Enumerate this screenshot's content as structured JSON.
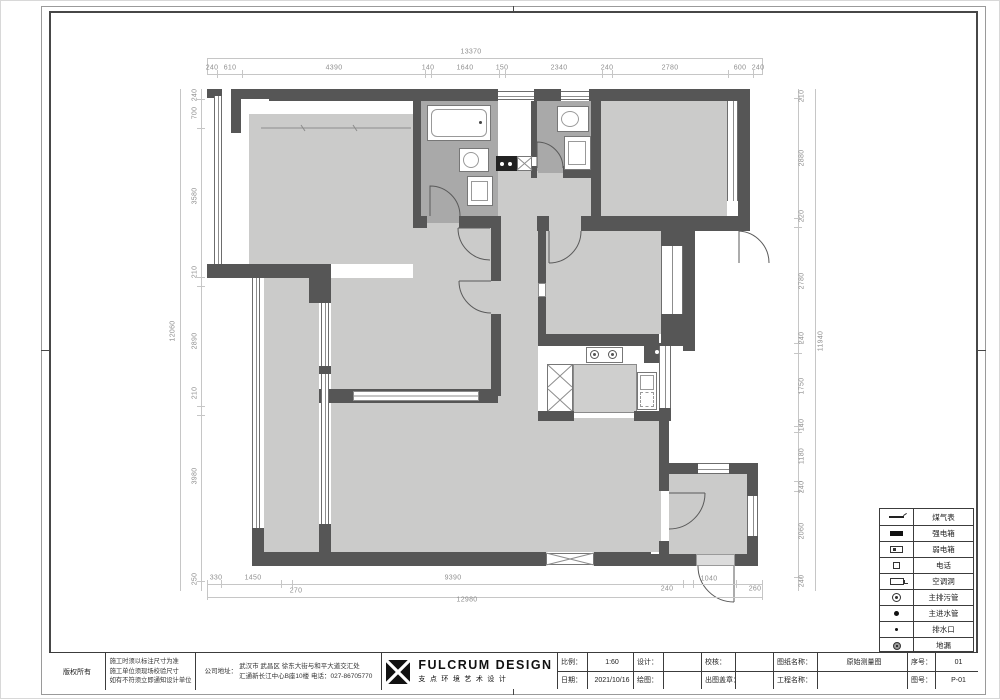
{
  "sheet": {
    "doc_type_note": "architectural floor plan sheet"
  },
  "dimensions": {
    "top": {
      "overall": "13370",
      "segments": [
        "240",
        "610",
        "4390",
        "140",
        "1640",
        "150",
        "2340",
        "240",
        "2780",
        "600",
        "240"
      ]
    },
    "left": {
      "overall": "12060",
      "segments": [
        "240",
        "700",
        "3580",
        "210",
        "2890",
        "210",
        "3980",
        "250"
      ]
    },
    "right": {
      "overall": "11940",
      "segments": [
        "210",
        "2880",
        "220",
        "2780",
        "240",
        "1750",
        "140",
        "1180",
        "240",
        "2060",
        "240"
      ]
    },
    "bottom": {
      "overall": "12980",
      "segments": [
        "330",
        "1450",
        "270",
        "9390",
        "240",
        "1040",
        "260"
      ]
    }
  },
  "legend": {
    "rows": [
      {
        "icon": "gas-meter-icon",
        "label": "煤气表"
      },
      {
        "icon": "strong-power-box-icon",
        "label": "强电箱"
      },
      {
        "icon": "weak-power-box-icon",
        "label": "弱电箱"
      },
      {
        "icon": "telephone-icon",
        "label": "电话"
      },
      {
        "icon": "ac-hole-icon",
        "label": "空调洞"
      },
      {
        "icon": "main-sewage-pipe-icon",
        "label": "主排污管"
      },
      {
        "icon": "main-water-inlet-icon",
        "label": "主进水管"
      },
      {
        "icon": "drain-outlet-icon",
        "label": "排水口"
      },
      {
        "icon": "floor-drain-icon",
        "label": "地漏"
      }
    ]
  },
  "title_block": {
    "copyright": "版权所有",
    "notes": [
      "施工时须以标注尺寸为准",
      "施工单位须现场校验尺寸",
      "如有不符须立即通知设计单位"
    ],
    "address_label": "公司地址：",
    "address_line1": "武汉市 武昌区 徐东大街与和平大道交汇处",
    "address_line2": "汇通新长江中心B座10楼 电话：027-86705770",
    "brand_en": "FULCRUM DESIGN",
    "brand_cn": "支点环境艺术设计",
    "row1": [
      {
        "label": "比例：",
        "value": "1:60"
      },
      {
        "label": "设计：",
        "value": ""
      },
      {
        "label": "校核：",
        "value": ""
      },
      {
        "label": "图纸名称：",
        "value": "原始测量图"
      },
      {
        "label": "序号：",
        "value": "01"
      }
    ],
    "row2": [
      {
        "label": "日期：",
        "value": "2021/10/16"
      },
      {
        "label": "绘图：",
        "value": ""
      },
      {
        "label": "出图盖章：",
        "value": ""
      },
      {
        "label": "工程名称：",
        "value": ""
      },
      {
        "label": "图号：",
        "value": "P-01"
      }
    ]
  }
}
